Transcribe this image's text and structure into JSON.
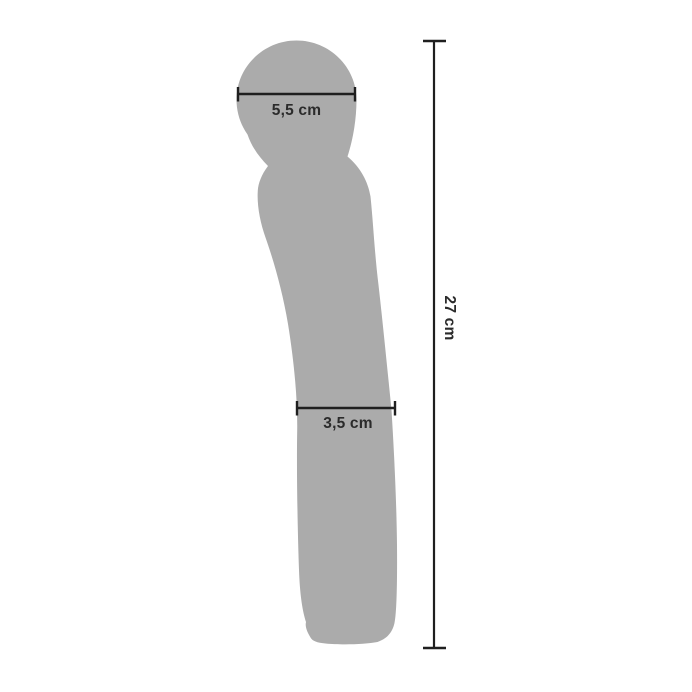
{
  "colors": {
    "background": "#ffffff",
    "silhouette": "#ababab",
    "dimension_line": "#1f1f1f",
    "label_text": "#2b2b2b"
  },
  "diagram": {
    "measurements": {
      "head_width": {
        "label": "5,5 cm"
      },
      "shaft_width": {
        "label": "3,5 cm"
      },
      "total_length": {
        "label": "27 cm"
      }
    }
  }
}
